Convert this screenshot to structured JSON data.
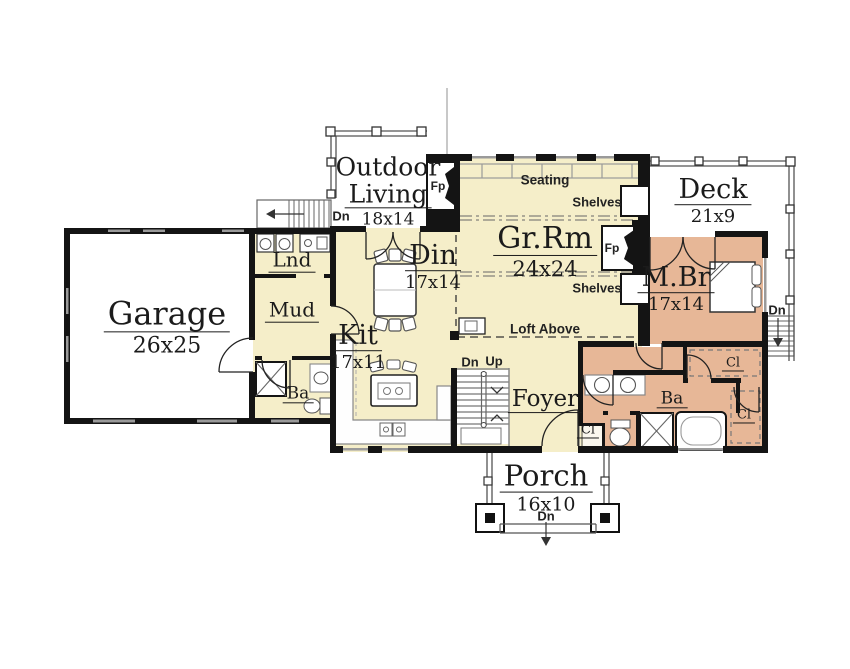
{
  "colors": {
    "interior_main": "#f5eec9",
    "master_suite": "#e7b797",
    "outdoor_rooms": "#ffffff",
    "walls": "#141414",
    "window_line": "#9a9a9a"
  },
  "rooms": {
    "garage": {
      "name": "Garage",
      "dims": "26x25"
    },
    "laundry": {
      "name": "Lnd"
    },
    "mud_room": {
      "name": "Mud"
    },
    "hall_bath": {
      "name": "Ba"
    },
    "outdoor_living": {
      "name_line1": "Outdoor",
      "name_line2": "Living",
      "dims": "18x14"
    },
    "dining": {
      "name": "Din",
      "dims": "17x14"
    },
    "great_room": {
      "name": "Gr.Rm",
      "dims": "24x24"
    },
    "deck": {
      "name": "Deck",
      "dims": "21x9"
    },
    "master_bedroom": {
      "name": "M.Br",
      "dims": "17x14"
    },
    "kitchen": {
      "name": "Kit",
      "dims": "17x11"
    },
    "foyer": {
      "name": "Foyer"
    },
    "master_bath": {
      "name": "Ba"
    },
    "closet_foyer": {
      "name": "Cl"
    },
    "closet_upper": {
      "name": "Cl"
    },
    "closet_lower": {
      "name": "Cl"
    },
    "porch": {
      "name": "Porch",
      "dims": "16x10"
    }
  },
  "annotations": {
    "seating": "Seating",
    "shelves_upper": "Shelves",
    "shelves_lower": "Shelves",
    "loft": "Loft Above",
    "fireplace_outdoor": "Fp",
    "fireplace_great": "Fp",
    "down_outdoor": "Dn",
    "down_main": "Dn",
    "up_main": "Up",
    "down_deck": "Dn",
    "down_porch": "Dn"
  }
}
